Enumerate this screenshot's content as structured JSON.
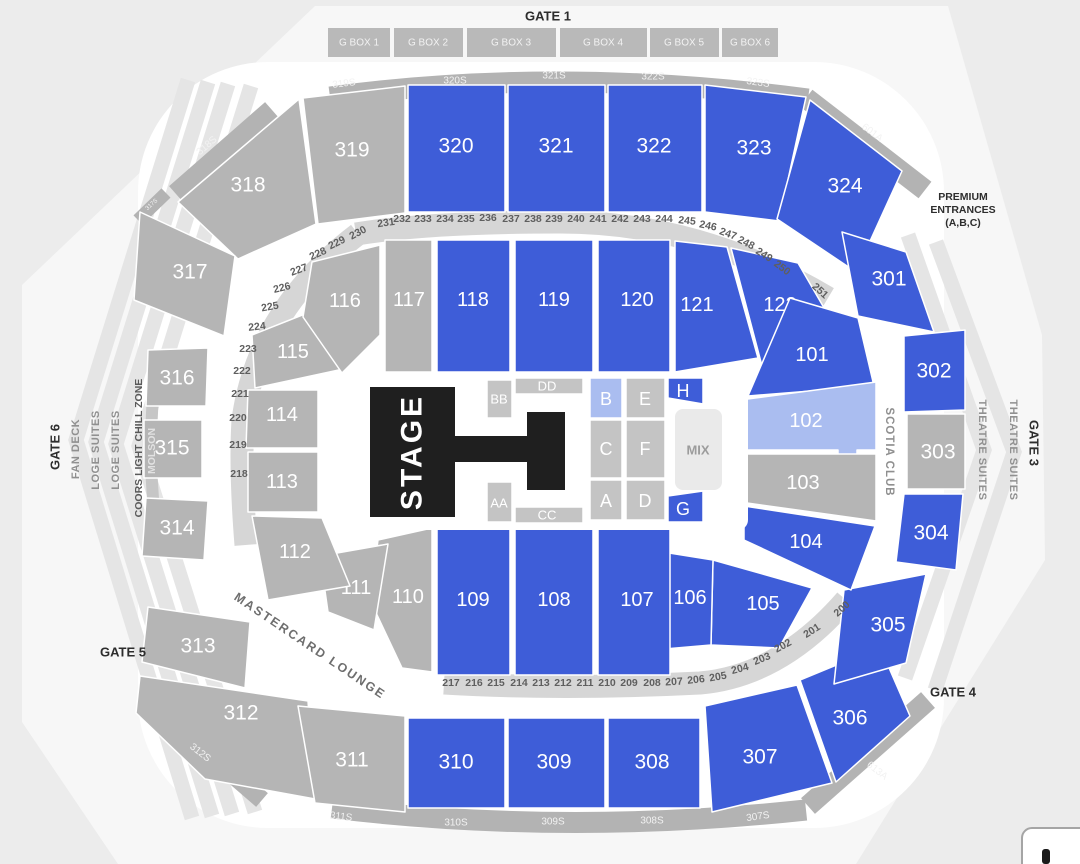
{
  "colors": {
    "available": "#3E5DD8",
    "highlighted": "#AABDF0",
    "unavailable": "#B5B5B5",
    "floor_zone": "#C4C4C4",
    "stage": "#1F1F1F",
    "band": "#B3B3B3",
    "ring_band": "#D6D6D6",
    "background": "#ECECEC"
  },
  "gates": {
    "gate1": "GATE 1",
    "gate3": "GATE 3",
    "gate4": "GATE 4",
    "gate5": "GATE 5",
    "gate6": "GATE 6"
  },
  "gbox": {
    "labels": [
      "G BOX 1",
      "G BOX 2",
      "G BOX 3",
      "G BOX 4",
      "G BOX 5",
      "G BOX 6"
    ]
  },
  "side": {
    "premium1": "PREMIUM",
    "premium2": "ENTRANCES",
    "premium3": "(A,B,C)",
    "theatre1": "THEATRE SUITES",
    "theatre2": "THEATRE SUITES",
    "scotia": "SCOTIA CLUB",
    "fan_deck": "FAN DECK",
    "loge1": "LOGE SUITES",
    "loge2": "LOGE SUITES",
    "coors": "COORS LIGHT CHILL ZONE",
    "molson": "MOLSON",
    "mastercard": "MASTERCARD LOUNGE"
  },
  "sband": {
    "s317": "317S",
    "s318": "318S",
    "s319": "319S",
    "s320": "320S",
    "s321": "321S",
    "s322": "322S",
    "s323": "323S",
    "a601": "601A",
    "s312": "312S",
    "s311": "311S",
    "s310": "310S",
    "s309": "309S",
    "s308": "308S",
    "s307": "307S",
    "a613": "613A"
  },
  "sec300": {
    "s301": {
      "label": "301",
      "status": "available"
    },
    "s302": {
      "label": "302",
      "status": "available"
    },
    "s303": {
      "label": "303",
      "status": "unavailable"
    },
    "s304": {
      "label": "304",
      "status": "available"
    },
    "s305": {
      "label": "305",
      "status": "available"
    },
    "s306": {
      "label": "306",
      "status": "available"
    },
    "s307": {
      "label": "307",
      "status": "available"
    },
    "s308": {
      "label": "308",
      "status": "available"
    },
    "s309": {
      "label": "309",
      "status": "available"
    },
    "s310": {
      "label": "310",
      "status": "available"
    },
    "s311": {
      "label": "311",
      "status": "unavailable"
    },
    "s312": {
      "label": "312",
      "status": "unavailable"
    },
    "s313": {
      "label": "313",
      "status": "unavailable"
    },
    "s314": {
      "label": "314",
      "status": "unavailable"
    },
    "s315": {
      "label": "315",
      "status": "unavailable"
    },
    "s316": {
      "label": "316",
      "status": "unavailable"
    },
    "s317": {
      "label": "317",
      "status": "unavailable"
    },
    "s318": {
      "label": "318",
      "status": "unavailable"
    },
    "s319": {
      "label": "319",
      "status": "unavailable"
    },
    "s320": {
      "label": "320",
      "status": "available"
    },
    "s321": {
      "label": "321",
      "status": "available"
    },
    "s322": {
      "label": "322",
      "status": "available"
    },
    "s323": {
      "label": "323",
      "status": "available"
    },
    "s324": {
      "label": "324",
      "status": "available"
    }
  },
  "sec100": {
    "s101": {
      "label": "101",
      "status": "available"
    },
    "s102": {
      "label": "102",
      "status": "highlighted"
    },
    "s103": {
      "label": "103",
      "status": "unavailable"
    },
    "s104": {
      "label": "104",
      "status": "available"
    },
    "s105": {
      "label": "105",
      "status": "available"
    },
    "s106": {
      "label": "106",
      "status": "available"
    },
    "s107": {
      "label": "107",
      "status": "available"
    },
    "s108": {
      "label": "108",
      "status": "available"
    },
    "s109": {
      "label": "109",
      "status": "available"
    },
    "s110": {
      "label": "110",
      "status": "unavailable"
    },
    "s111": {
      "label": "111",
      "status": "unavailable"
    },
    "s112": {
      "label": "112",
      "status": "unavailable"
    },
    "s113": {
      "label": "113",
      "status": "unavailable"
    },
    "s114": {
      "label": "114",
      "status": "unavailable"
    },
    "s115": {
      "label": "115",
      "status": "unavailable"
    },
    "s116": {
      "label": "116",
      "status": "unavailable"
    },
    "s117": {
      "label": "117",
      "status": "unavailable"
    },
    "s118": {
      "label": "118",
      "status": "available"
    },
    "s119": {
      "label": "119",
      "status": "available"
    },
    "s120": {
      "label": "120",
      "status": "available"
    },
    "s121": {
      "label": "121",
      "status": "available"
    },
    "s122": {
      "label": "122",
      "status": "available"
    }
  },
  "floor": {
    "stage": "STAGE",
    "mix": "MIX",
    "a": "A",
    "b": "B",
    "c": "C",
    "d": "D",
    "e": "E",
    "f": "F",
    "g": "G",
    "h": "H",
    "aa": "AA",
    "bb": "BB",
    "cc": "CC",
    "dd": "DD"
  },
  "rings": {
    "top": [
      "231",
      "232",
      "233",
      "234",
      "235",
      "236",
      "237",
      "238",
      "239",
      "240",
      "241",
      "242",
      "243",
      "244",
      "245",
      "246",
      "247",
      "248",
      "249",
      "250",
      "251"
    ],
    "left": [
      "230",
      "229",
      "228",
      "227",
      "226",
      "225",
      "224",
      "223",
      "222",
      "221",
      "220",
      "219",
      "218"
    ],
    "bottom": [
      "217",
      "216",
      "215",
      "214",
      "213",
      "212",
      "211",
      "210",
      "209",
      "208",
      "207",
      "206",
      "205",
      "204",
      "203",
      "202",
      "201",
      "200"
    ]
  }
}
